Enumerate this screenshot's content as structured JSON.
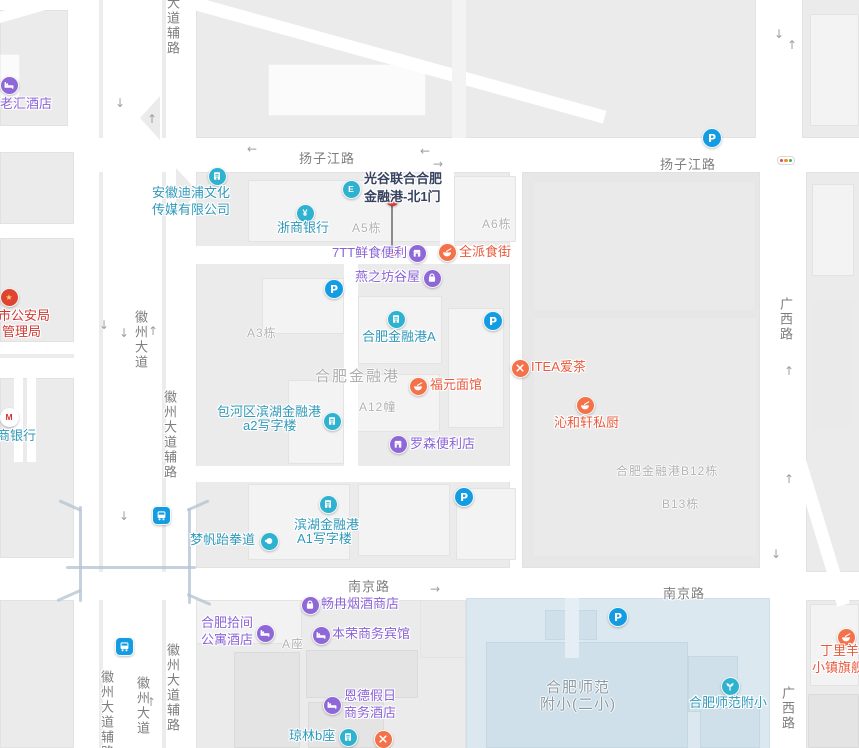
{
  "map": {
    "colors": {
      "teal_icon": "#2fb2cf",
      "teal_text": "#2f99b9",
      "purple_icon": "#8f68d8",
      "purple_text": "#8a63d6",
      "orange_icon": "#f3724a",
      "orange_text": "#e85a3d",
      "blue_transit": "#149ce2",
      "red_marker": "#e8413c",
      "police_red": "#ce3a33",
      "dark_title": "#36425f",
      "road_label": "#7e7e7e",
      "building_label": "#b2b2b2",
      "school_label": "#8d9ba3",
      "campus_label": "#aeaeae",
      "overpass": "#b3c1d3",
      "cmb_red": "#c9362e",
      "emblem_bg": "#de4430"
    },
    "pois": [
      {
        "id": "laohui-hotel",
        "icon": "hotel",
        "s": "purple",
        "ix": 8,
        "iy": 84,
        "lines": [
          {
            "t": "老汇酒店",
            "x": 0,
            "y": 97
          }
        ]
      },
      {
        "id": "anhui-dipu-company",
        "icon": "building",
        "s": "teal",
        "ix": 216,
        "iy": 175,
        "lines": [
          {
            "t": "安徽迪浦文化",
            "x": 152,
            "y": 186
          },
          {
            "t": "传媒有限公司",
            "x": 152,
            "y": 203
          }
        ]
      },
      {
        "id": "zheshang-bank",
        "icon": "bank",
        "s": "teal",
        "ix": 304,
        "iy": 212,
        "lines": [
          {
            "t": "浙商银行",
            "x": 277,
            "y": 221
          }
        ]
      },
      {
        "id": "guanggu-north-gate",
        "icon": "entrance",
        "s": "teal",
        "tc": "dark_title",
        "fw": 700,
        "ix": 350,
        "iy": 188,
        "lines": [
          {
            "t": "光谷联合合肥",
            "x": 364,
            "y": 172
          },
          {
            "t": "金融港-北1门",
            "x": 364,
            "y": 190
          }
        ]
      },
      {
        "id": "7tt-fresh-store",
        "icon": "store",
        "s": "purple",
        "ix": 416,
        "iy": 252,
        "lines": [
          {
            "t": "7TT鲜食便利",
            "x": 332,
            "y": 246
          }
        ]
      },
      {
        "id": "quanpai-food-street",
        "icon": "bowl",
        "s": "orange",
        "ix": 446,
        "iy": 251,
        "lines": [
          {
            "t": "全派食街",
            "x": 459,
            "y": 245
          }
        ]
      },
      {
        "id": "yanzhifang-guwu",
        "icon": "bag",
        "s": "purple",
        "ix": 431,
        "iy": 277,
        "lines": [
          {
            "t": "燕之坊谷屋",
            "x": 355,
            "y": 270
          }
        ]
      },
      {
        "id": "hefei-jinronggang-a",
        "icon": "building",
        "s": "teal",
        "ix": 395,
        "iy": 318,
        "lines": [
          {
            "t": "合肥金融港A",
            "x": 362,
            "y": 330
          }
        ]
      },
      {
        "id": "fuyuan-noodle",
        "icon": "bowl",
        "s": "orange",
        "ix": 417,
        "iy": 385,
        "lines": [
          {
            "t": "福元面馆",
            "x": 430,
            "y": 378
          }
        ]
      },
      {
        "id": "itea-tea",
        "icon": "cross",
        "s": "orange",
        "ix": 519,
        "iy": 367,
        "lines": [
          {
            "t": "ITEA爱茶",
            "x": 531,
            "y": 360
          }
        ]
      },
      {
        "id": "qinhexuan-kitchen",
        "icon": "bowl",
        "s": "orange",
        "ix": 584,
        "iy": 404,
        "lines": [
          {
            "t": "沁和轩私厨",
            "x": 554,
            "y": 416
          }
        ]
      },
      {
        "id": "a2-office-tower",
        "icon": "building",
        "s": "teal",
        "ix": 331,
        "iy": 420,
        "lines": [
          {
            "t": "包河区滨湖金融港",
            "x": 217,
            "y": 405
          },
          {
            "t": "a2写字楼",
            "x": 243,
            "y": 419
          }
        ]
      },
      {
        "id": "lawson-store",
        "icon": "store",
        "s": "purple",
        "ix": 397,
        "iy": 443,
        "lines": [
          {
            "t": "罗森便利店",
            "x": 410,
            "y": 437
          }
        ]
      },
      {
        "id": "cmb-bank",
        "icon": "cmb",
        "s": "cmb",
        "ix": 8,
        "iy": 416,
        "lines": [
          {
            "t": "商银行",
            "x": -3,
            "y": 429
          }
        ]
      },
      {
        "id": "police-bureau",
        "icon": "emblem",
        "s": "emblem",
        "ix": 8,
        "iy": 296,
        "lines": [
          {
            "t": "市公安局",
            "x": -2,
            "y": 309
          },
          {
            "t": "管理局",
            "x": 2,
            "y": 325
          }
        ]
      },
      {
        "id": "a1-office-tower",
        "icon": "building",
        "s": "teal",
        "ix": 327,
        "iy": 503,
        "lines": [
          {
            "t": "滨湖金融港",
            "x": 294,
            "y": 518
          },
          {
            "t": "A1写字楼",
            "x": 297,
            "y": 532
          }
        ]
      },
      {
        "id": "mengfan-taekwondo",
        "icon": "fist",
        "s": "teal",
        "ix": 268,
        "iy": 540,
        "lines": [
          {
            "t": "梦帆跆拳道",
            "x": 190,
            "y": 533
          }
        ]
      },
      {
        "id": "changran-tobacco",
        "icon": "bag",
        "s": "purple",
        "ix": 309,
        "iy": 604,
        "lines": [
          {
            "t": "畅冉烟酒商店",
            "x": 321,
            "y": 597
          }
        ]
      },
      {
        "id": "shijian-apartment-hotel",
        "icon": "hotel",
        "s": "purple",
        "ix": 264,
        "iy": 632,
        "lines": [
          {
            "t": "合肥拾间",
            "x": 201,
            "y": 616
          },
          {
            "t": "公寓酒店",
            "x": 201,
            "y": 633
          }
        ]
      },
      {
        "id": "benrong-hotel",
        "icon": "hotel",
        "s": "purple",
        "ix": 320,
        "iy": 634,
        "lines": [
          {
            "t": "本荣商务宾馆",
            "x": 332,
            "y": 627
          }
        ]
      },
      {
        "id": "ende-holiday-hotel",
        "icon": "hotel",
        "s": "purple",
        "ix": 331,
        "iy": 704,
        "lines": [
          {
            "t": "恩德假日",
            "x": 344,
            "y": 689
          },
          {
            "t": "商务酒店",
            "x": 344,
            "y": 706
          }
        ]
      },
      {
        "id": "qionglin-b",
        "icon": "building",
        "s": "teal",
        "ix": 347,
        "iy": 736,
        "lines": [
          {
            "t": "琼林b座",
            "x": 289,
            "y": 729
          }
        ]
      },
      {
        "id": "restaurant-unnamed",
        "icon": "cross",
        "s": "orange",
        "ix": 382,
        "iy": 738,
        "lines": []
      },
      {
        "id": "shifan-fuxiao-school",
        "icon": "leaf",
        "s": "teal",
        "ix": 729,
        "iy": 685,
        "lines": [
          {
            "t": "合肥师范附小",
            "x": 689,
            "y": 696
          }
        ]
      },
      {
        "id": "dingliyang-flagship",
        "icon": "bowl",
        "s": "orange",
        "ix": 845,
        "iy": 636,
        "lines": [
          {
            "t": "丁里羊",
            "x": 820,
            "y": 644
          },
          {
            "t": "小镇旗舰",
            "x": 812,
            "y": 661
          }
        ]
      },
      {
        "id": "parking-1",
        "icon": "parking",
        "s": "transit",
        "ix": 712,
        "iy": 138,
        "lines": []
      },
      {
        "id": "parking-2",
        "icon": "parking",
        "s": "transit",
        "ix": 334,
        "iy": 289,
        "lines": []
      },
      {
        "id": "parking-3",
        "icon": "parking",
        "s": "transit",
        "ix": 493,
        "iy": 321,
        "lines": []
      },
      {
        "id": "parking-4",
        "icon": "parking",
        "s": "transit",
        "ix": 464,
        "iy": 497,
        "lines": []
      },
      {
        "id": "parking-5",
        "icon": "parking",
        "s": "transit",
        "ix": 618,
        "iy": 617,
        "lines": []
      },
      {
        "id": "bus-stop-1",
        "icon": "bus",
        "s": "transit",
        "ix": 160,
        "iy": 514,
        "lines": []
      },
      {
        "id": "bus-stop-2",
        "icon": "bus",
        "s": "transit",
        "ix": 123,
        "iy": 645,
        "lines": []
      }
    ],
    "gate_marker": {
      "x": 392,
      "head_y": 199,
      "stem_top": 205,
      "stem_bottom": 246,
      "bar_y": 251
    },
    "traffic_light": {
      "x": 786,
      "y": 161
    },
    "road_labels": [
      {
        "t": "扬子江路",
        "x": 299,
        "y": 148
      },
      {
        "t": "扬子江路",
        "x": 660,
        "y": 154
      },
      {
        "t": "南京路",
        "x": 348,
        "y": 576
      },
      {
        "t": "南京路",
        "x": 663,
        "y": 583
      },
      {
        "t": "徽州大道",
        "x": 131,
        "y": 310,
        "v": 1
      },
      {
        "t": "徽州大道",
        "x": 133,
        "y": 676,
        "v": 1
      },
      {
        "t": "大道辅路",
        "x": 163,
        "y": -4,
        "v": 1
      },
      {
        "t": "徽州大道辅路",
        "x": 160,
        "y": 390,
        "v": 1
      },
      {
        "t": "徽州大道辅路",
        "x": 97,
        "y": 670,
        "v": 1
      },
      {
        "t": "徽州大道辅路",
        "x": 163,
        "y": 643,
        "v": 1
      },
      {
        "t": "广西路",
        "x": 776,
        "y": 297,
        "v": 1
      },
      {
        "t": "广西路",
        "x": 778,
        "y": 686,
        "v": 1
      }
    ],
    "building_labels": [
      {
        "t": "A5栋",
        "x": 352,
        "y": 219
      },
      {
        "t": "A6栋",
        "x": 482,
        "y": 215
      },
      {
        "t": "A3栋",
        "x": 247,
        "y": 324
      },
      {
        "t": "A12幢",
        "x": 359,
        "y": 398
      },
      {
        "t": "合肥金融港",
        "x": 315,
        "y": 365,
        "fs": 15,
        "ls": 2
      },
      {
        "t": "合肥金融港B12栋",
        "x": 616,
        "y": 462
      },
      {
        "t": "B13栋",
        "x": 662,
        "y": 495
      },
      {
        "t": "A座",
        "x": 282,
        "y": 635
      },
      {
        "t": "合肥师范",
        "x": 546,
        "y": 676,
        "fs": 15,
        "cls": "school"
      },
      {
        "t": "附小(二小)",
        "x": 540,
        "y": 693,
        "fs": 15,
        "cls": "school"
      }
    ],
    "arrows": [
      {
        "c": "↓",
        "x": 120,
        "y": 103
      },
      {
        "c": "↑",
        "x": 152,
        "y": 119
      },
      {
        "c": "←",
        "x": 252,
        "y": 149
      },
      {
        "c": "←",
        "x": 425,
        "y": 151
      },
      {
        "c": "→",
        "x": 438,
        "y": 164
      },
      {
        "c": "↓",
        "x": 779,
        "y": 34
      },
      {
        "c": "↑",
        "x": 792,
        "y": 45
      },
      {
        "c": "↓",
        "x": 104,
        "y": 325
      },
      {
        "c": "↓",
        "x": 124,
        "y": 333
      },
      {
        "c": "↑",
        "x": 153,
        "y": 331
      },
      {
        "c": "↑",
        "x": 789,
        "y": 371
      },
      {
        "c": "↑",
        "x": 789,
        "y": 479
      },
      {
        "c": "↓",
        "x": 124,
        "y": 516
      },
      {
        "c": "→",
        "x": 435,
        "y": 589
      },
      {
        "c": "↓",
        "x": 776,
        "y": 554
      },
      {
        "c": "↑",
        "x": 151,
        "y": 702
      }
    ]
  }
}
